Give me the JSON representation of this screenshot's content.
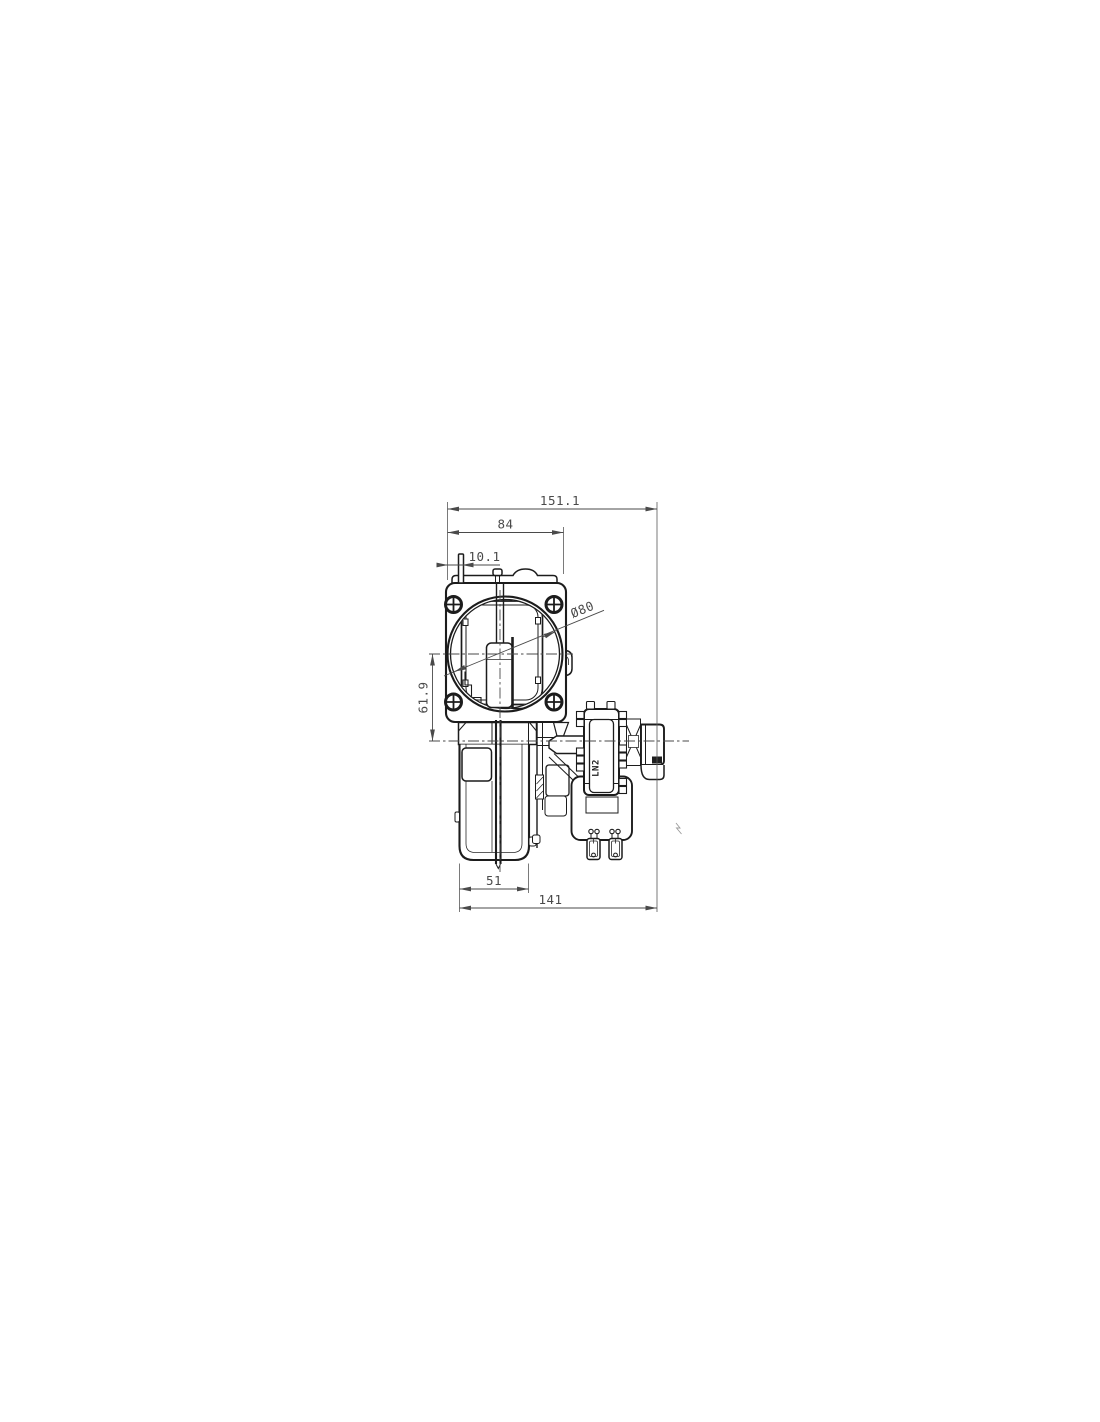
{
  "page": {
    "background": "#ffffff"
  },
  "drawing": {
    "dimensions": {
      "overall_width_mm": "151.1",
      "flange_width_mm": "84",
      "flange_offset_mm": "10.1",
      "axis_offset_mm": "61.9",
      "motor_body_width_mm": "51",
      "body_width_mm": "141",
      "fan_diameter": "Ø80"
    },
    "labels": {
      "motor_marking": "LN2"
    },
    "colors": {
      "outline": "#1c1c1c",
      "dimension": "#4a4a4a",
      "background": "#ffffff"
    }
  }
}
